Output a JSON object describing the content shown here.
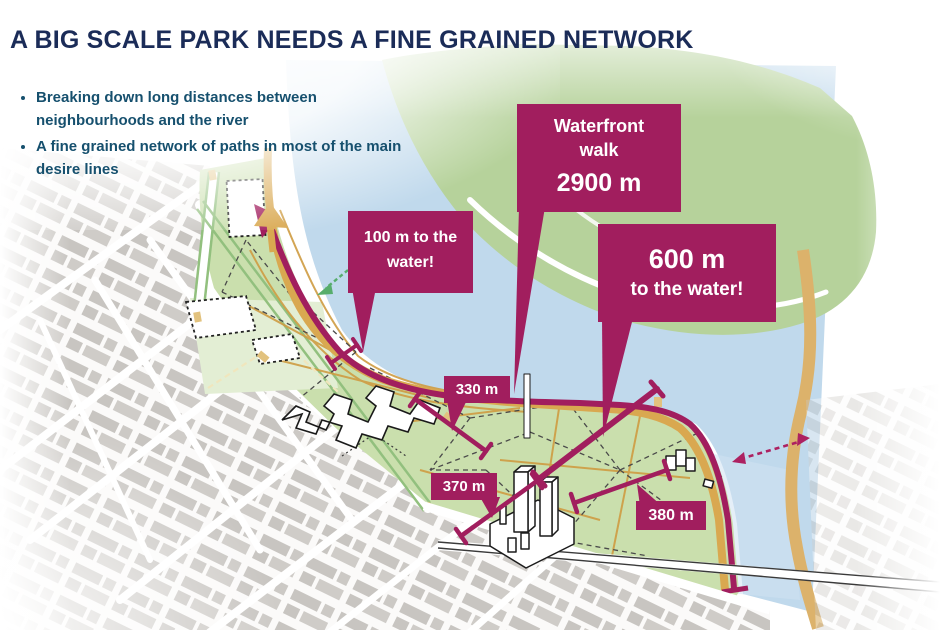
{
  "slide": {
    "title": "A BIG SCALE PARK NEEDS A FINE GRAINED NETWORK",
    "bullets": [
      "Breaking down long distances between neighbourhoods and the river",
      "A fine grained network of paths in most of the main desire lines"
    ]
  },
  "map": {
    "callouts": {
      "waterfront": {
        "line1": "Waterfront",
        "line2": "walk",
        "value": "2900 m"
      },
      "water100": {
        "line1": "100 m to the",
        "line2": "water!"
      },
      "water600": {
        "value": "600 m",
        "caption": "to the water!"
      },
      "d330": "330 m",
      "d370": "370 m",
      "d380": "380 m"
    },
    "colors": {
      "accent_magenta": "#a11e5e",
      "park_green": "#cadfad",
      "forest_green": "#b6d29b",
      "water_blue": "#c0d9ec",
      "path_orange": "#d9a850",
      "title_navy": "#1b2c58",
      "bullet_teal": "#16506e"
    }
  }
}
